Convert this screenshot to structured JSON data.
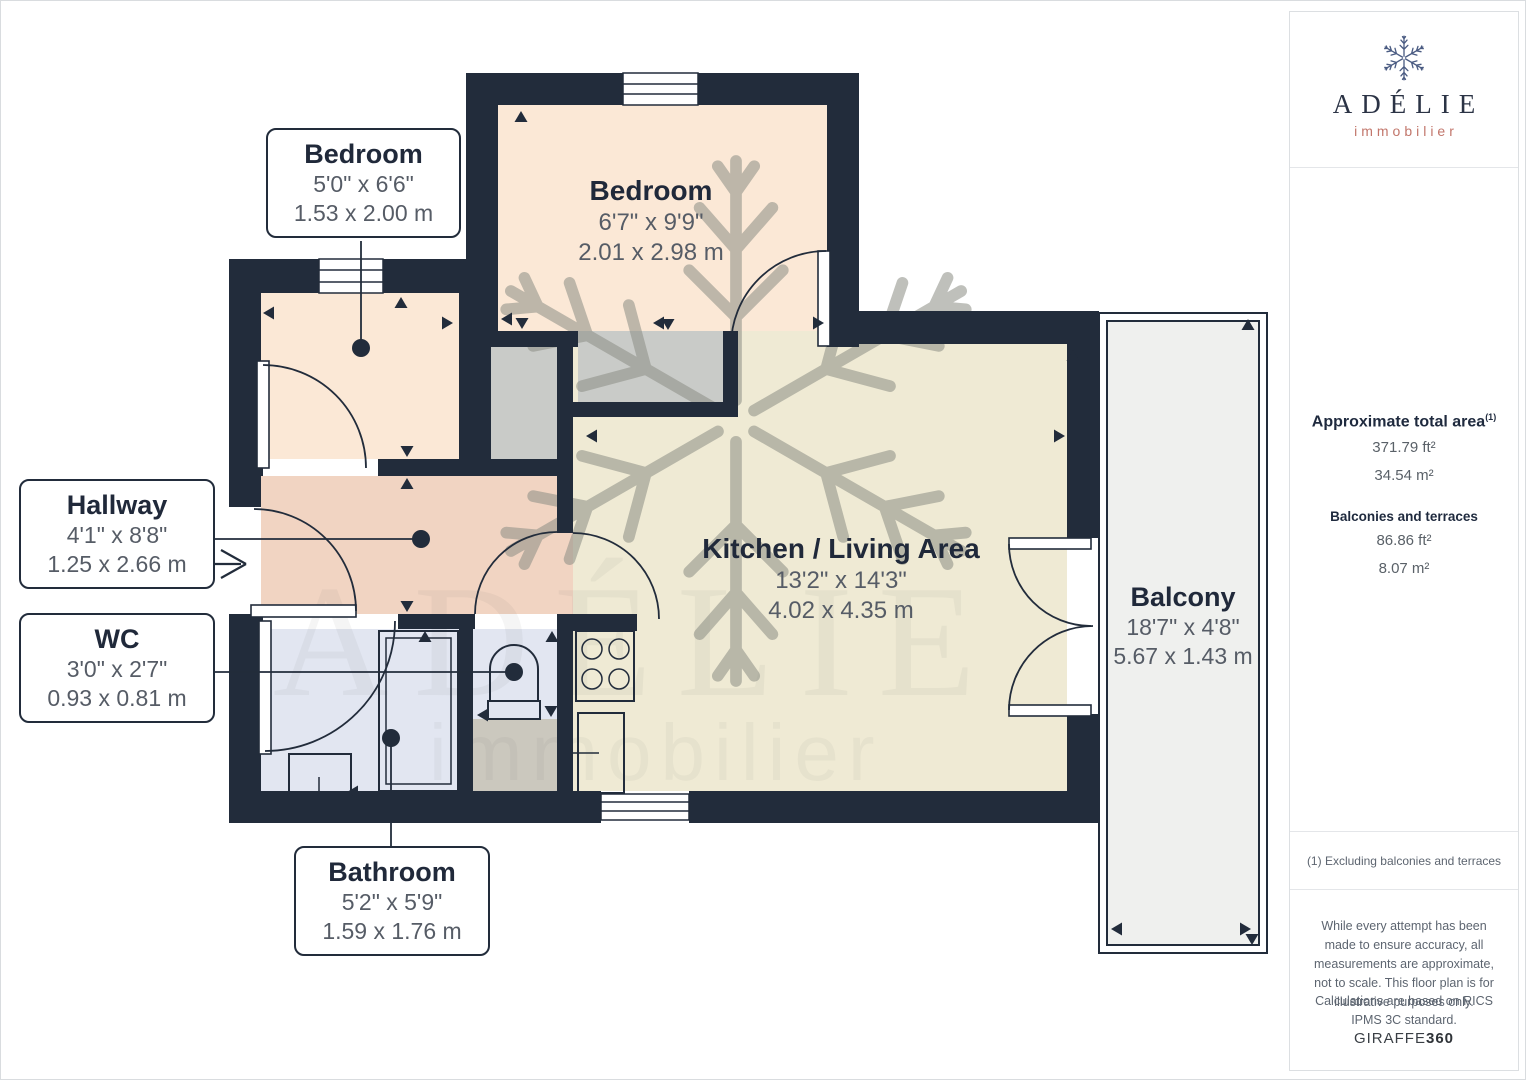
{
  "rooms": {
    "bedroom_small": {
      "name": "Bedroom",
      "imperial": "5'0\" x 6'6\"",
      "metric": "1.53 x 2.00 m"
    },
    "bedroom_large": {
      "name": "Bedroom",
      "imperial": "6'7\" x 9'9\"",
      "metric": "2.01 x 2.98 m"
    },
    "hallway": {
      "name": "Hallway",
      "imperial": "4'1\" x 8'8\"",
      "metric": "1.25 x 2.66 m"
    },
    "wc": {
      "name": "WC",
      "imperial": "3'0\" x 2'7\"",
      "metric": "0.93 x 0.81 m"
    },
    "bathroom": {
      "name": "Bathroom",
      "imperial": "5'2\" x 5'9\"",
      "metric": "1.59 x 1.76 m"
    },
    "kitchen_living": {
      "name": "Kitchen / Living Area",
      "imperial": "13'2\" x 14'3\"",
      "metric": "4.02 x 4.35 m"
    },
    "balcony": {
      "name": "Balcony",
      "imperial": "18'7\" x 4'8\"",
      "metric": "5.67 x 1.43 m"
    }
  },
  "sidebar": {
    "brand": "ADÉLIE",
    "brand_sub": "immobilier",
    "area_heading": "Approximate total area",
    "area_heading_sup": "(1)",
    "area_ft": "371.79 ft²",
    "area_m": "34.54 m²",
    "balconies_heading": "Balconies and terraces",
    "balcony_ft": "86.86 ft²",
    "balcony_m": "8.07 m²",
    "note": "(1) Excluding balconies and terraces",
    "disclaimer1": "While every attempt has been made to ensure accuracy, all measurements are approximate, not to scale. This floor plan is for illustrative purposes only.",
    "disclaimer2": "Calculations are based on RICS IPMS 3C standard.",
    "footer_brand_a": "GIRAFFE",
    "footer_brand_b": "360"
  },
  "watermark": {
    "line1": "ADÉLIE",
    "line2": "immobilier"
  },
  "colors": {
    "wall": "#222C3B",
    "bedroom": "#FBE8D6",
    "hallway": "#F1D4C2",
    "bath": "#E2E6F1",
    "kitchen": "#EFEAD4",
    "niche": "#C9CBC8",
    "wcgray": "#CBC8BE",
    "balcony": "#EFF0EE",
    "accent": "#C2766B",
    "navy": "#20293A",
    "dim": "#565C66"
  }
}
